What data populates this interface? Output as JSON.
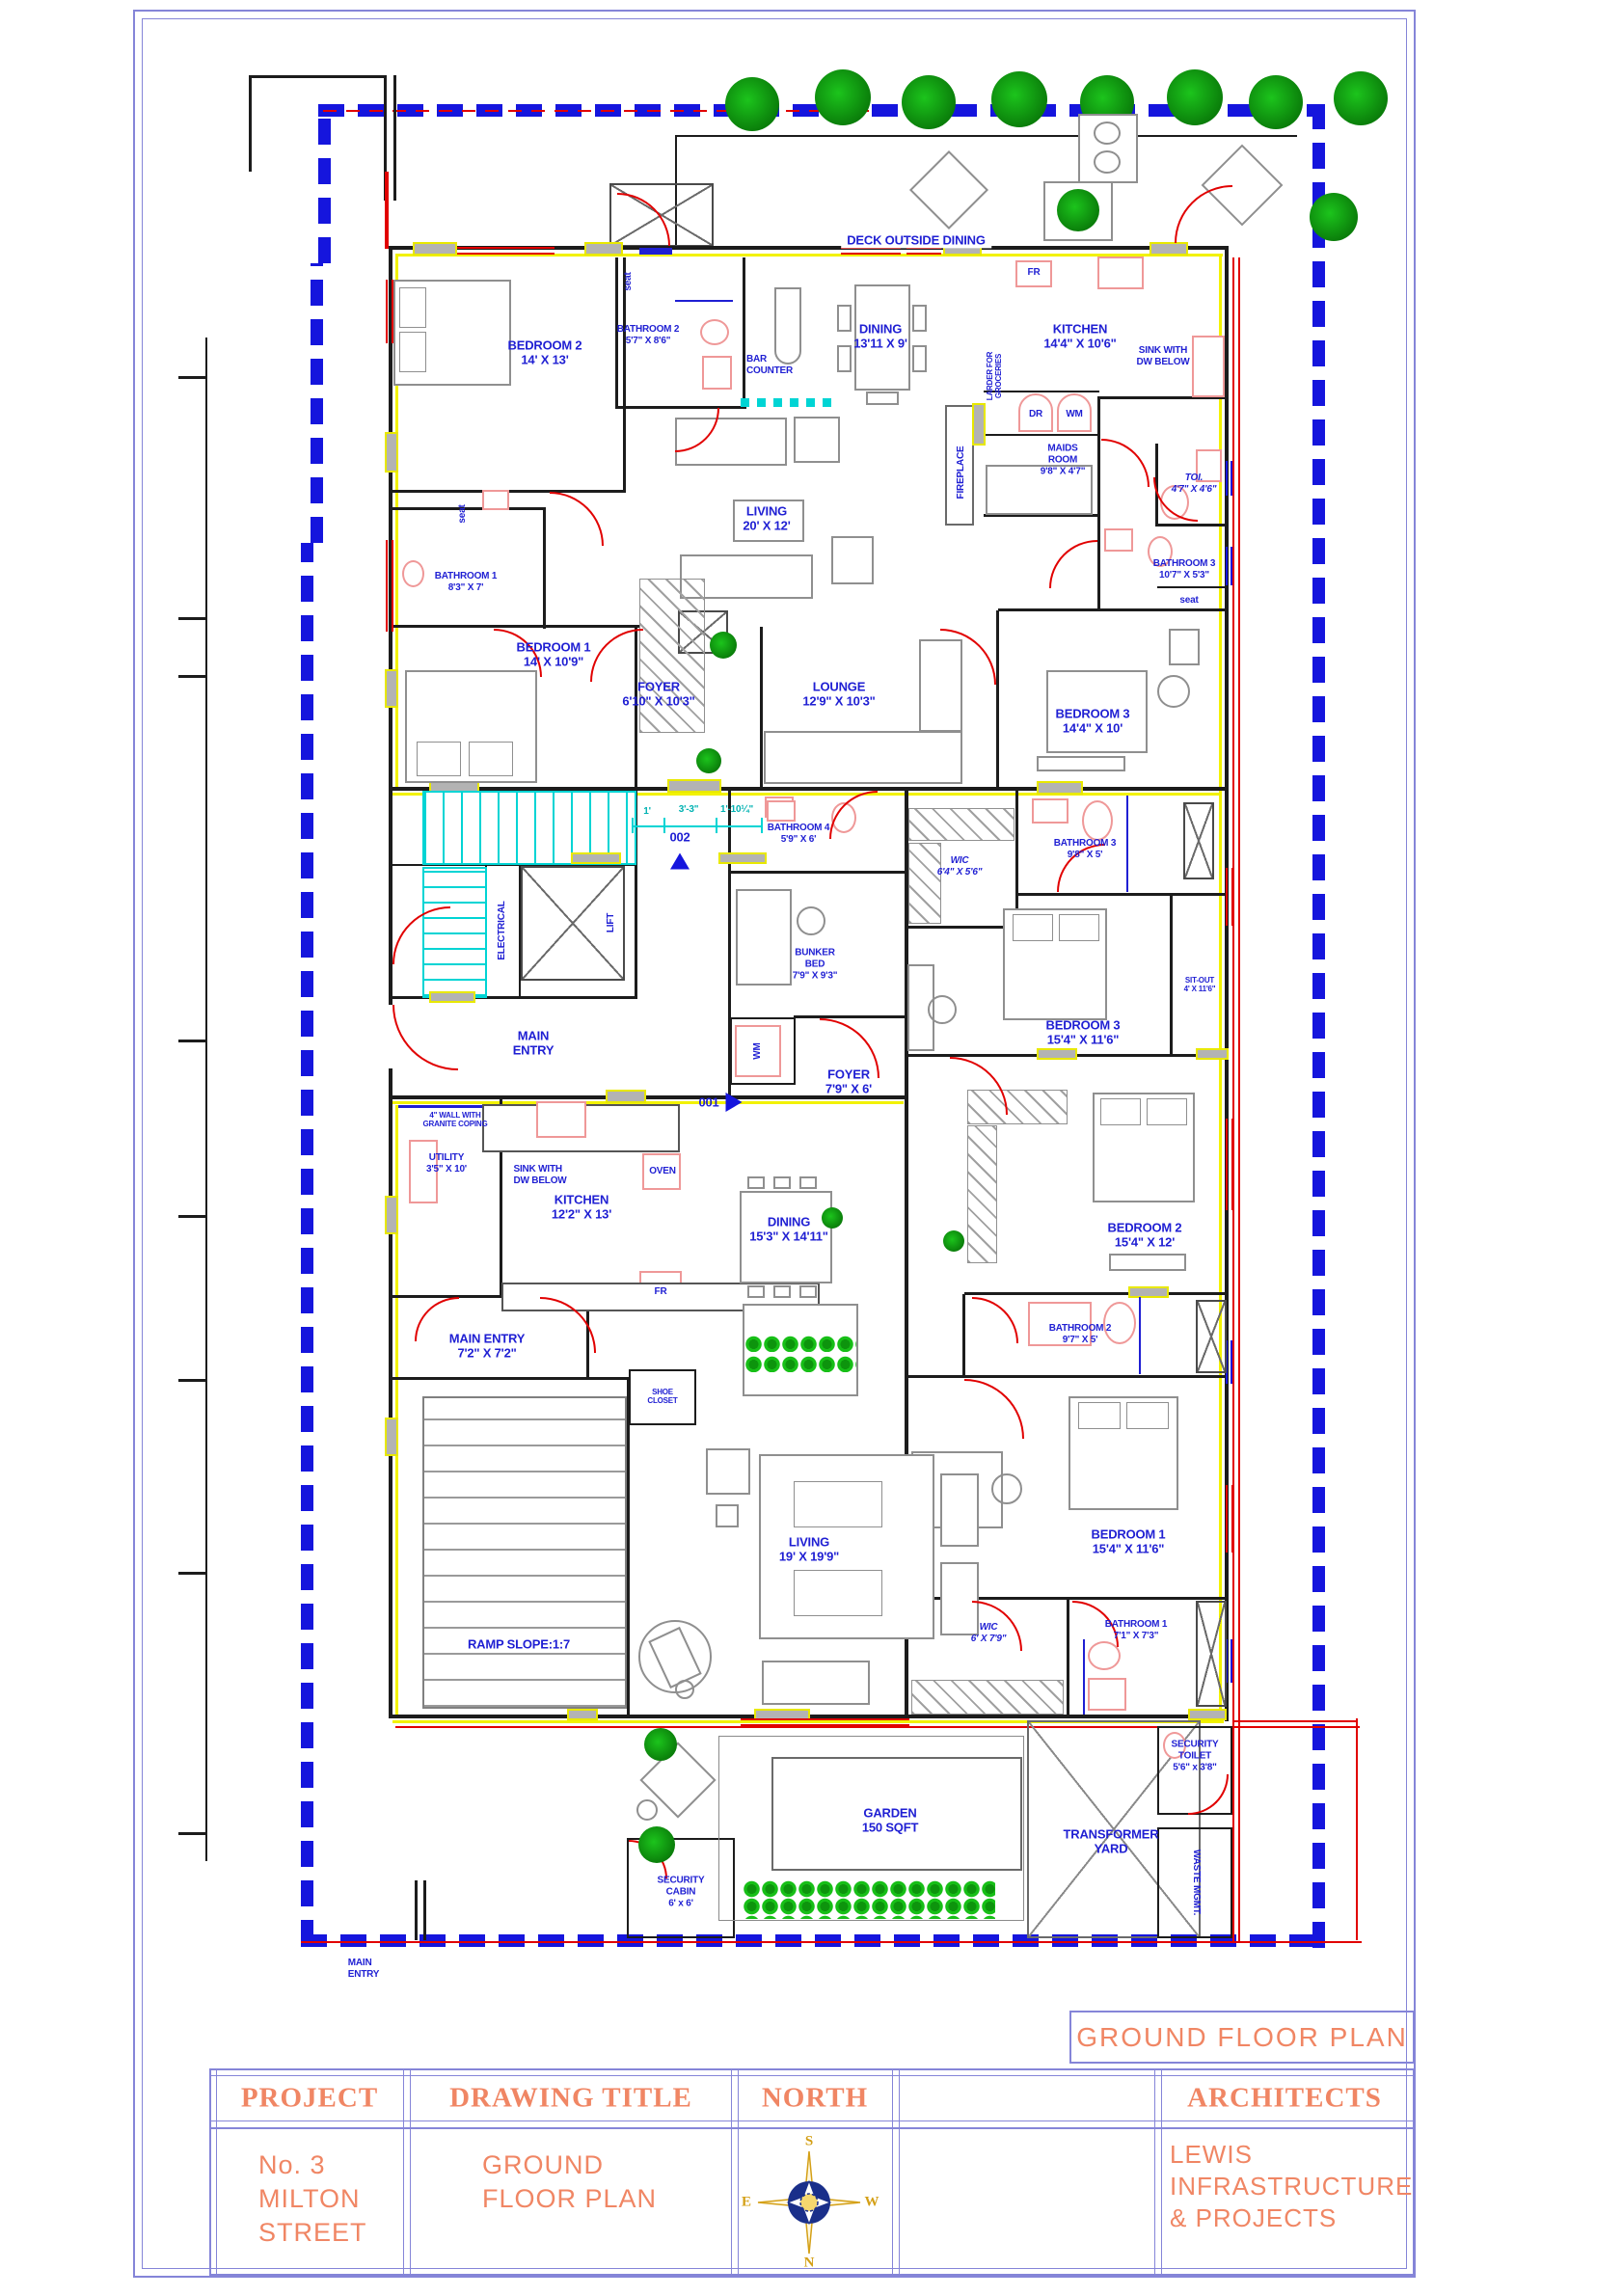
{
  "colors": {
    "label_blue": "#1f1fd3",
    "wall_black": "#1c1c1c",
    "wall_yellow": "#f2f200",
    "door_red": "#e10000",
    "fixture_pink": "#ef9898",
    "stair_cyan": "#00d4d4",
    "plant_green": "#12b012",
    "boundary_blue": "#1515dd",
    "frame_purple": "#8585d8",
    "title_orange": "#f08664"
  },
  "unitA": {
    "bedroom2": "BEDROOM 2\n14' X 13'",
    "bathroom2": "BATHROOM 2\n5'7\" X 8'6\"",
    "seat_top": "seat",
    "seat_left": "seat",
    "seat_right": "seat",
    "bar": "BAR\nCOUNTER",
    "dining": "DINING\n13'11 X 9'",
    "kitchen": "KITCHEN\n14'4\" X 10'6\"",
    "sink": "SINK WITH\nDW BELOW",
    "fr": "FR",
    "larder": "LARDER FOR\nGROCERIES",
    "dr": "DR",
    "wm": "WM",
    "maids": "MAIDS\nROOM\n9'8\" X 4'7\"",
    "fireplace": "FIREPLACE",
    "toi": "TOI.\n4'7\" X 4'6\"",
    "bathroom3": "BATHROOM 3\n10'7\" X 5'3\"",
    "living": "LIVING\n20' X 12'",
    "bathroom1": "BATHROOM 1\n8'3\" X 7'",
    "bedroom1": "BEDROOM 1\n14' X 10'9\"",
    "foyer": "FOYER\n6'10\" X 10'3\"",
    "lounge": "LOUNGE\n12'9\" X 10'3\"",
    "bedroom3": "BEDROOM 3\n14'4\" X 10'",
    "deck": "DECK OUTSIDE DINING"
  },
  "core": {
    "electrical": "ELECTRICAL",
    "lift": "LIFT",
    "door002": "002",
    "door001": "001",
    "dim1": "1'",
    "dim2": "3'-3\"",
    "dim3": "1'-10¼\"",
    "main_entry": "MAIN\nENTRY",
    "bathroom4": "BATHROOM 4\n5'9\" X 6'",
    "bunker": "BUNKER\nBED\n7'9\" X 9'3\"",
    "wm": "WM",
    "foyer": "FOYER\n7'9\" X 6'"
  },
  "unitB": {
    "utility": "UTILITY\n3'5\" X 10'",
    "granite": "4\" WALL WITH\nGRANITE COPING",
    "sink": "SINK WITH\nDW BELOW",
    "kitchen": "KITCHEN\n12'2\" X 13'",
    "oven": "OVEN",
    "fr": "FR",
    "dining": "DINING\n15'3\" X 14'11\"",
    "main_entry": "MAIN ENTRY\n7'2\" X 7'2\"",
    "shoe": "SHOE\nCLOSET",
    "ramp": "RAMP SLOPE:1:7",
    "living": "LIVING\n19' X 19'9\"",
    "wic_b3": "WIC\n6'4\" X 5'6\"",
    "bathroom3": "BATHROOM 3\n9'8\" X 5'",
    "bedroom3": "BEDROOM 3\n15'4\" X 11'6\"",
    "sitout": "SIT-OUT\n4' X 11'6\"",
    "bedroom2": "BEDROOM 2\n15'4\" X 12'",
    "bathroom2": "BATHROOM 2\n9'7\" X 5'",
    "bedroom1": "BEDROOM 1\n15'4\" X 11'6\"",
    "wic_b1": "WIC\n6' X 7'9\"",
    "bathroom1": "BATHROOM 1\n7'1\" X 7'3\""
  },
  "outdoor": {
    "cabin": "SECURITY\nCABIN\n6' x 6'",
    "garden": "GARDEN\n150 SQFT",
    "transformer": "TRANSFORMER\nYARD",
    "sec_toilet": "SECURITY\nTOILET\n5'6\" x 3'8\"",
    "waste": "WASTE MGMT.",
    "main_entry": "MAIN\nENTRY"
  },
  "titleblock": {
    "banner": "GROUND FLOOR PLAN",
    "h_project": "PROJECT",
    "h_drawing": "DRAWING TITLE",
    "h_north": "NORTH",
    "h_architects": "ARCHITECTS",
    "project": "No. 3\nMILTON\nSTREET",
    "drawing": "GROUND\nFLOOR PLAN",
    "architects": "LEWIS\nINFRASTRUCTURE\n& PROJECTS",
    "compass_n": "N",
    "compass_s": "S",
    "compass_e": "E",
    "compass_w": "W"
  }
}
